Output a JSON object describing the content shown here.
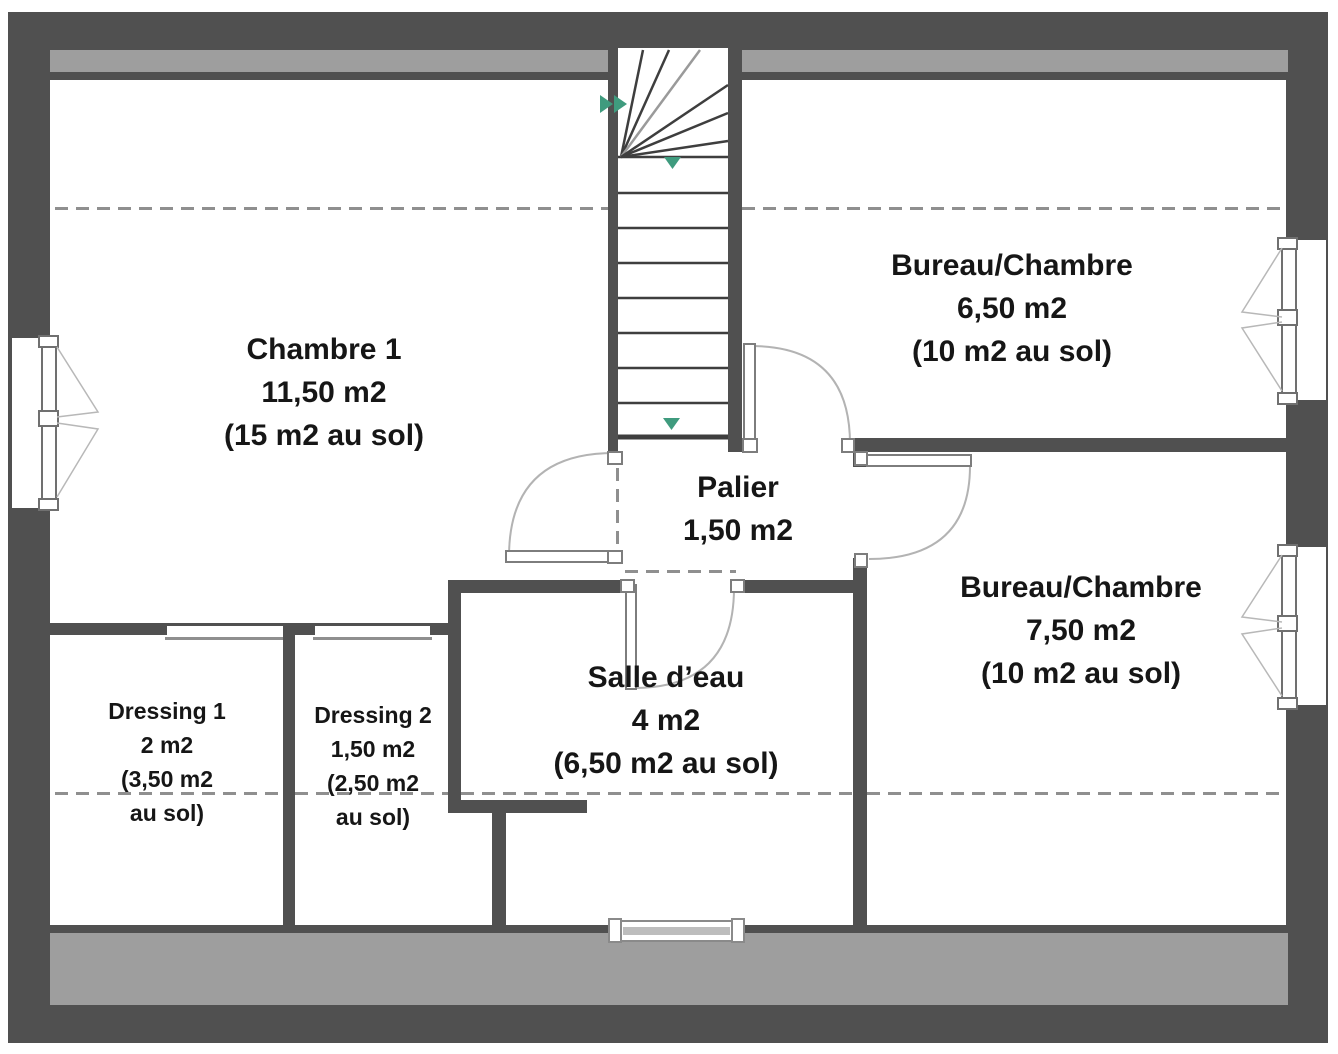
{
  "colors": {
    "wall": "#505050",
    "roof_band": "#9e9e9e",
    "dash": "#8f8f8f",
    "door": "#b3b3b3",
    "window_frame": "#707070",
    "arrow_green": "#3f9b7e",
    "text": "#161616",
    "background": "#ffffff"
  },
  "plan": {
    "rooms": [
      {
        "id": "chambre-1",
        "lines": [
          "Chambre 1",
          "11,50 m2",
          "(15 m2 au sol)"
        ]
      },
      {
        "id": "bureau-chambre-650",
        "lines": [
          "Bureau/Chambre",
          "6,50 m2",
          "(10 m2 au sol)"
        ]
      },
      {
        "id": "palier",
        "lines": [
          "Palier",
          "1,50 m2"
        ]
      },
      {
        "id": "bureau-chambre-750",
        "lines": [
          "Bureau/Chambre",
          "7,50 m2",
          "(10 m2 au sol)"
        ]
      },
      {
        "id": "salle-deau",
        "lines": [
          "Salle d’eau",
          "4 m2",
          "(6,50 m2 au sol)"
        ]
      },
      {
        "id": "dressing-1",
        "lines": [
          "Dressing 1",
          "2 m2",
          "(3,50 m2",
          "au sol)"
        ]
      },
      {
        "id": "dressing-2",
        "lines": [
          "Dressing 2",
          "1,50 m2",
          "(2,50 m2",
          "au sol)"
        ]
      }
    ]
  }
}
